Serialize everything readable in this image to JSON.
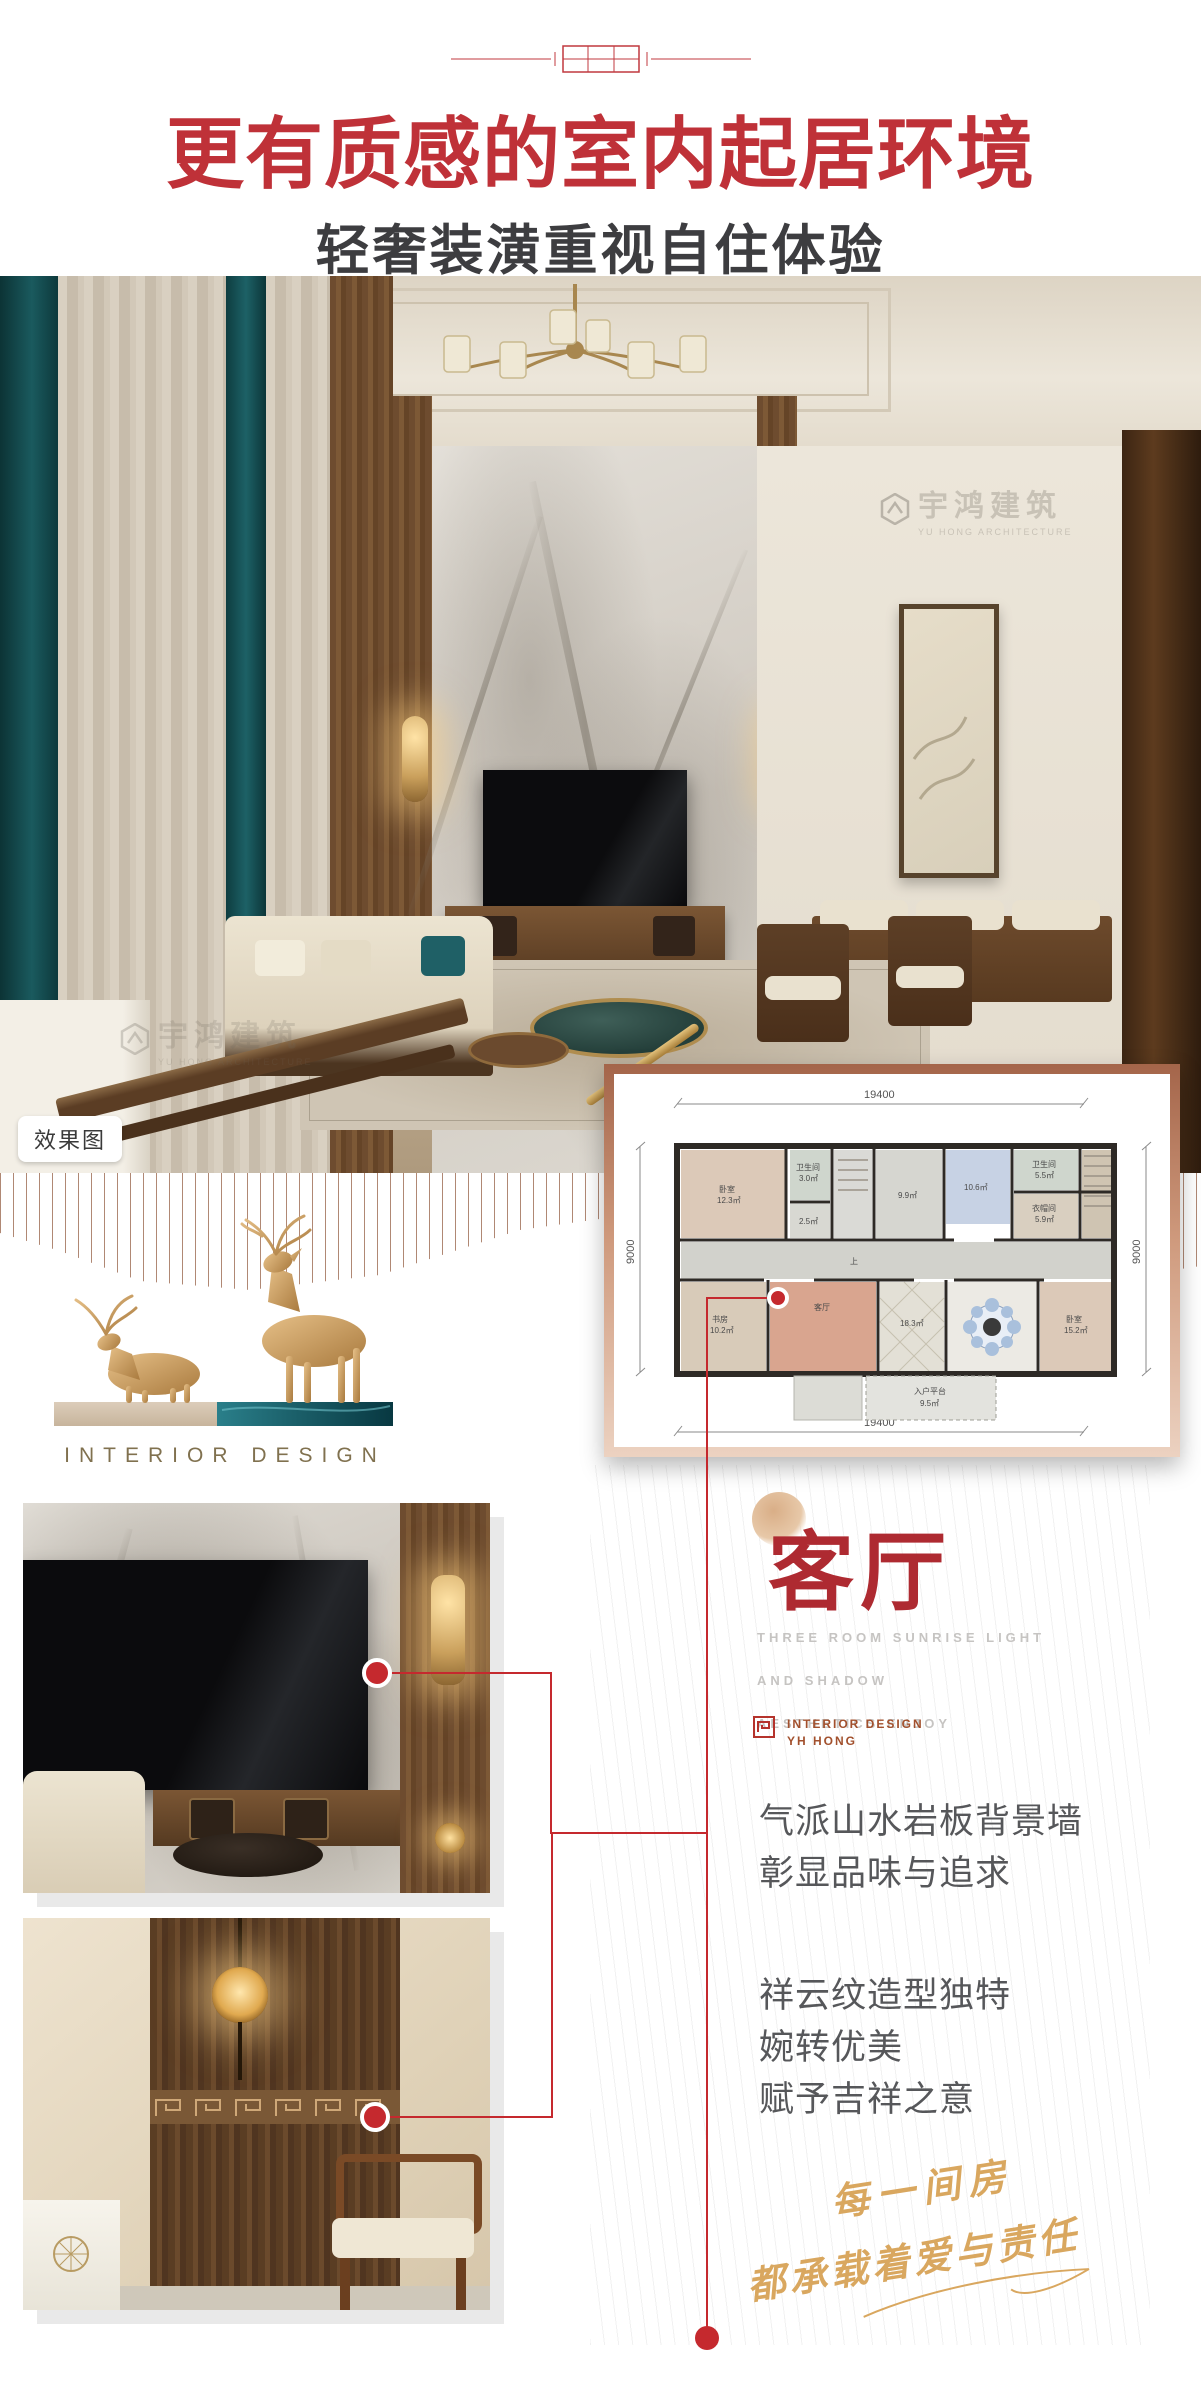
{
  "header": {
    "title": "更有质感的室内起居环境",
    "subtitle": "轻奢装潢重视自住体验",
    "title_color": "#bf3138"
  },
  "hero": {
    "tag": "效果图",
    "watermark": {
      "cn": "宇鸿建筑",
      "en": "YU HONG ARCHITECTURE"
    }
  },
  "plan": {
    "dims": {
      "top": "19400",
      "bottom": "19400",
      "left": "9000",
      "right": "9000"
    },
    "stairs_label": "上",
    "rooms": [
      {
        "name": "卧室",
        "area": "12.3㎡"
      },
      {
        "name": "卫生间",
        "area": "3.0㎡"
      },
      {
        "name": "",
        "area": "2.5㎡"
      },
      {
        "name": "",
        "area": "9.9㎡"
      },
      {
        "name": "",
        "area": "10.6㎡"
      },
      {
        "name": "卫生间",
        "area": "5.5㎡"
      },
      {
        "name": "衣帽间",
        "area": "5.9㎡"
      },
      {
        "name": "书房",
        "area": "10.2㎡"
      },
      {
        "name": "客厅",
        "area": ""
      },
      {
        "name": "",
        "area": "18.3㎡"
      },
      {
        "name": "卧室",
        "area": "15.2㎡"
      },
      {
        "name": "入户平台",
        "area": "9.5㎡"
      }
    ]
  },
  "brand": {
    "wordmark": "INTERIOR DESIGN"
  },
  "section": {
    "title": "客厅",
    "tagline": [
      "THREE ROOM SUNRISE LIGHT",
      "AND SHADOW",
      "AESTHETICS ENJOY"
    ],
    "studio": {
      "line1": "INTERIOR DESIGN",
      "line2": "YH HONG"
    }
  },
  "features": [
    {
      "lines": [
        "气派山水岩板背景墙",
        "彰显品味与追求"
      ]
    },
    {
      "lines": [
        "祥云纹造型独特",
        "婉转优美",
        "赋予吉祥之意"
      ]
    }
  ],
  "slogan": {
    "line1": "每一间房",
    "line2": "都承载着爱与责任",
    "color": "#d9a75f"
  },
  "colors": {
    "accent_red": "#c5292e",
    "title_red": "#bf3138",
    "gold": "#d9a75f",
    "teal": "#15545a",
    "plan_border_copper": "#a4654a"
  }
}
